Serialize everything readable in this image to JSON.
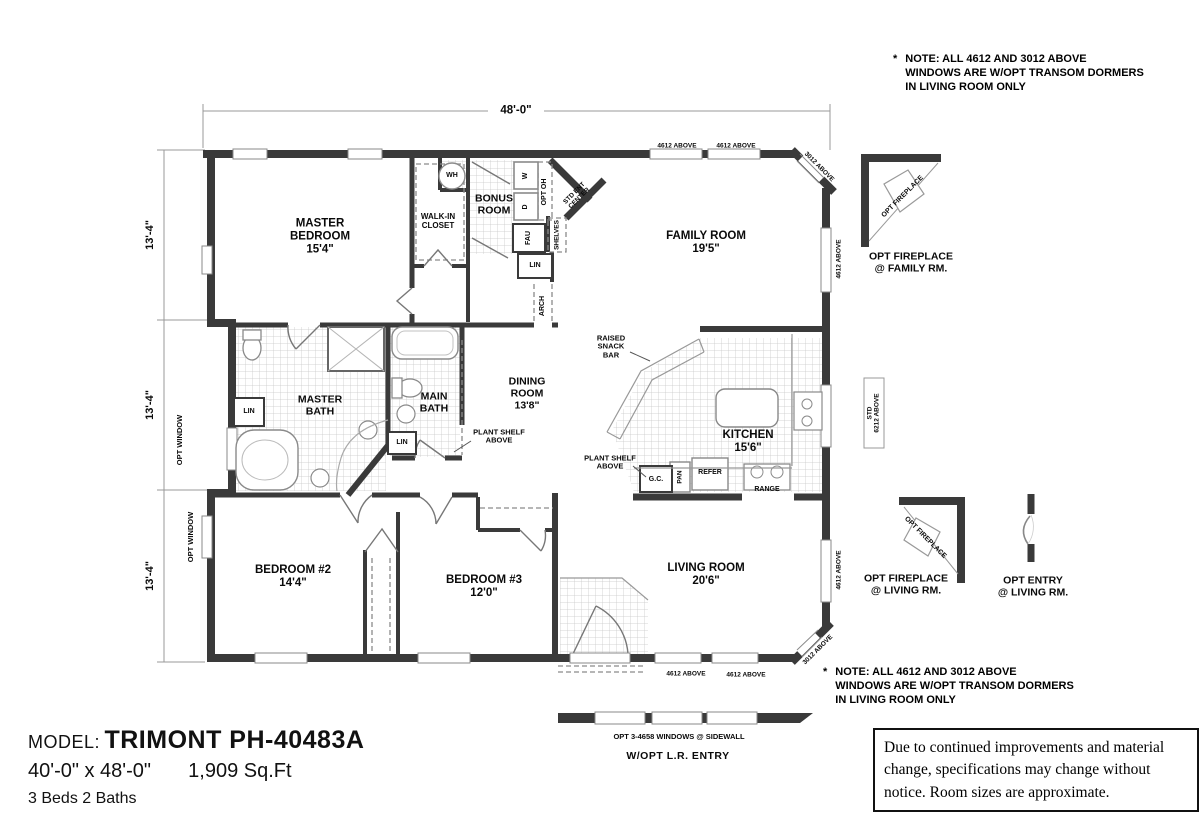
{
  "plan": {
    "width_dim": "48'-0\"",
    "depth_dims": [
      "13'-4\"",
      "13'-4\"",
      "13'-4\""
    ],
    "rooms": {
      "master_bedroom": {
        "name": "MASTER BEDROOM",
        "size": "15'4\""
      },
      "walk_in_closet": {
        "name": "WALK-IN CLOSET"
      },
      "bonus_room": {
        "name": "BONUS ROOM"
      },
      "family_room": {
        "name": "FAMILY ROOM",
        "size": "19'5\""
      },
      "master_bath": {
        "name": "MASTER BATH"
      },
      "main_bath": {
        "name": "MAIN BATH"
      },
      "dining_room": {
        "name": "DINING ROOM",
        "size": "13'8\""
      },
      "kitchen": {
        "name": "KITCHEN",
        "size": "15'6\""
      },
      "bedroom_2": {
        "name": "BEDROOM #2",
        "size": "14'4\""
      },
      "bedroom_3": {
        "name": "BEDROOM #3",
        "size": "12'0\""
      },
      "living_room": {
        "name": "LIVING ROOM",
        "size": "20'6\""
      }
    },
    "fixtures": {
      "wh": "WH",
      "washer": "W",
      "dryer": "D",
      "opt_oh": "OPT OH",
      "std_ent_center": "STD ENT CENTER",
      "shelves": "SHELVES",
      "fau": "FAU",
      "lin": "LIN",
      "arch": "ARCH",
      "gc": "G.C.",
      "pan": "PAN",
      "refer": "REFER",
      "range": "RANGE",
      "raised_snack_bar": "RAISED SNACK BAR",
      "plant_shelf_above": "PLANT SHELF ABOVE",
      "opt_window": "OPT WINDOW"
    },
    "windows": {
      "w4612": "4612 ABOVE",
      "w3012": "3012 ABOVE",
      "std_6212": {
        "l1": "STD",
        "l2": "6212 ABOVE"
      }
    }
  },
  "details": {
    "opt_fireplace_diag": "OPT FIREPLACE",
    "fireplace_family": {
      "l1": "OPT FIREPLACE",
      "l2": "@ FAMILY RM."
    },
    "fireplace_living": {
      "l1": "OPT FIREPLACE",
      "l2": "@ LIVING RM."
    },
    "entry_living": {
      "l1": "OPT ENTRY",
      "l2": "@ LIVING RM."
    },
    "opt_windows_sidewall": "OPT 3-4658 WINDOWS @ SIDEWALL",
    "opt_lr_entry": "W/OPT L.R. ENTRY"
  },
  "note": {
    "star": "*",
    "l1": "NOTE: ALL 4612 AND 3012 ABOVE",
    "l2": "WINDOWS ARE W/OPT TRANSOM DORMERS",
    "l3": "IN LIVING ROOM ONLY"
  },
  "footer": {
    "model_label": "MODEL:",
    "model_name": "TRIMONT PH-40483A",
    "dims": "40'-0\" x 48'-0\"",
    "sqft": "1,909 Sq.Ft",
    "beds": "3 Beds 2 Baths"
  },
  "disclaimer": "Due to continued improvements and material change, specifications may change without notice. Room sizes are approximate."
}
